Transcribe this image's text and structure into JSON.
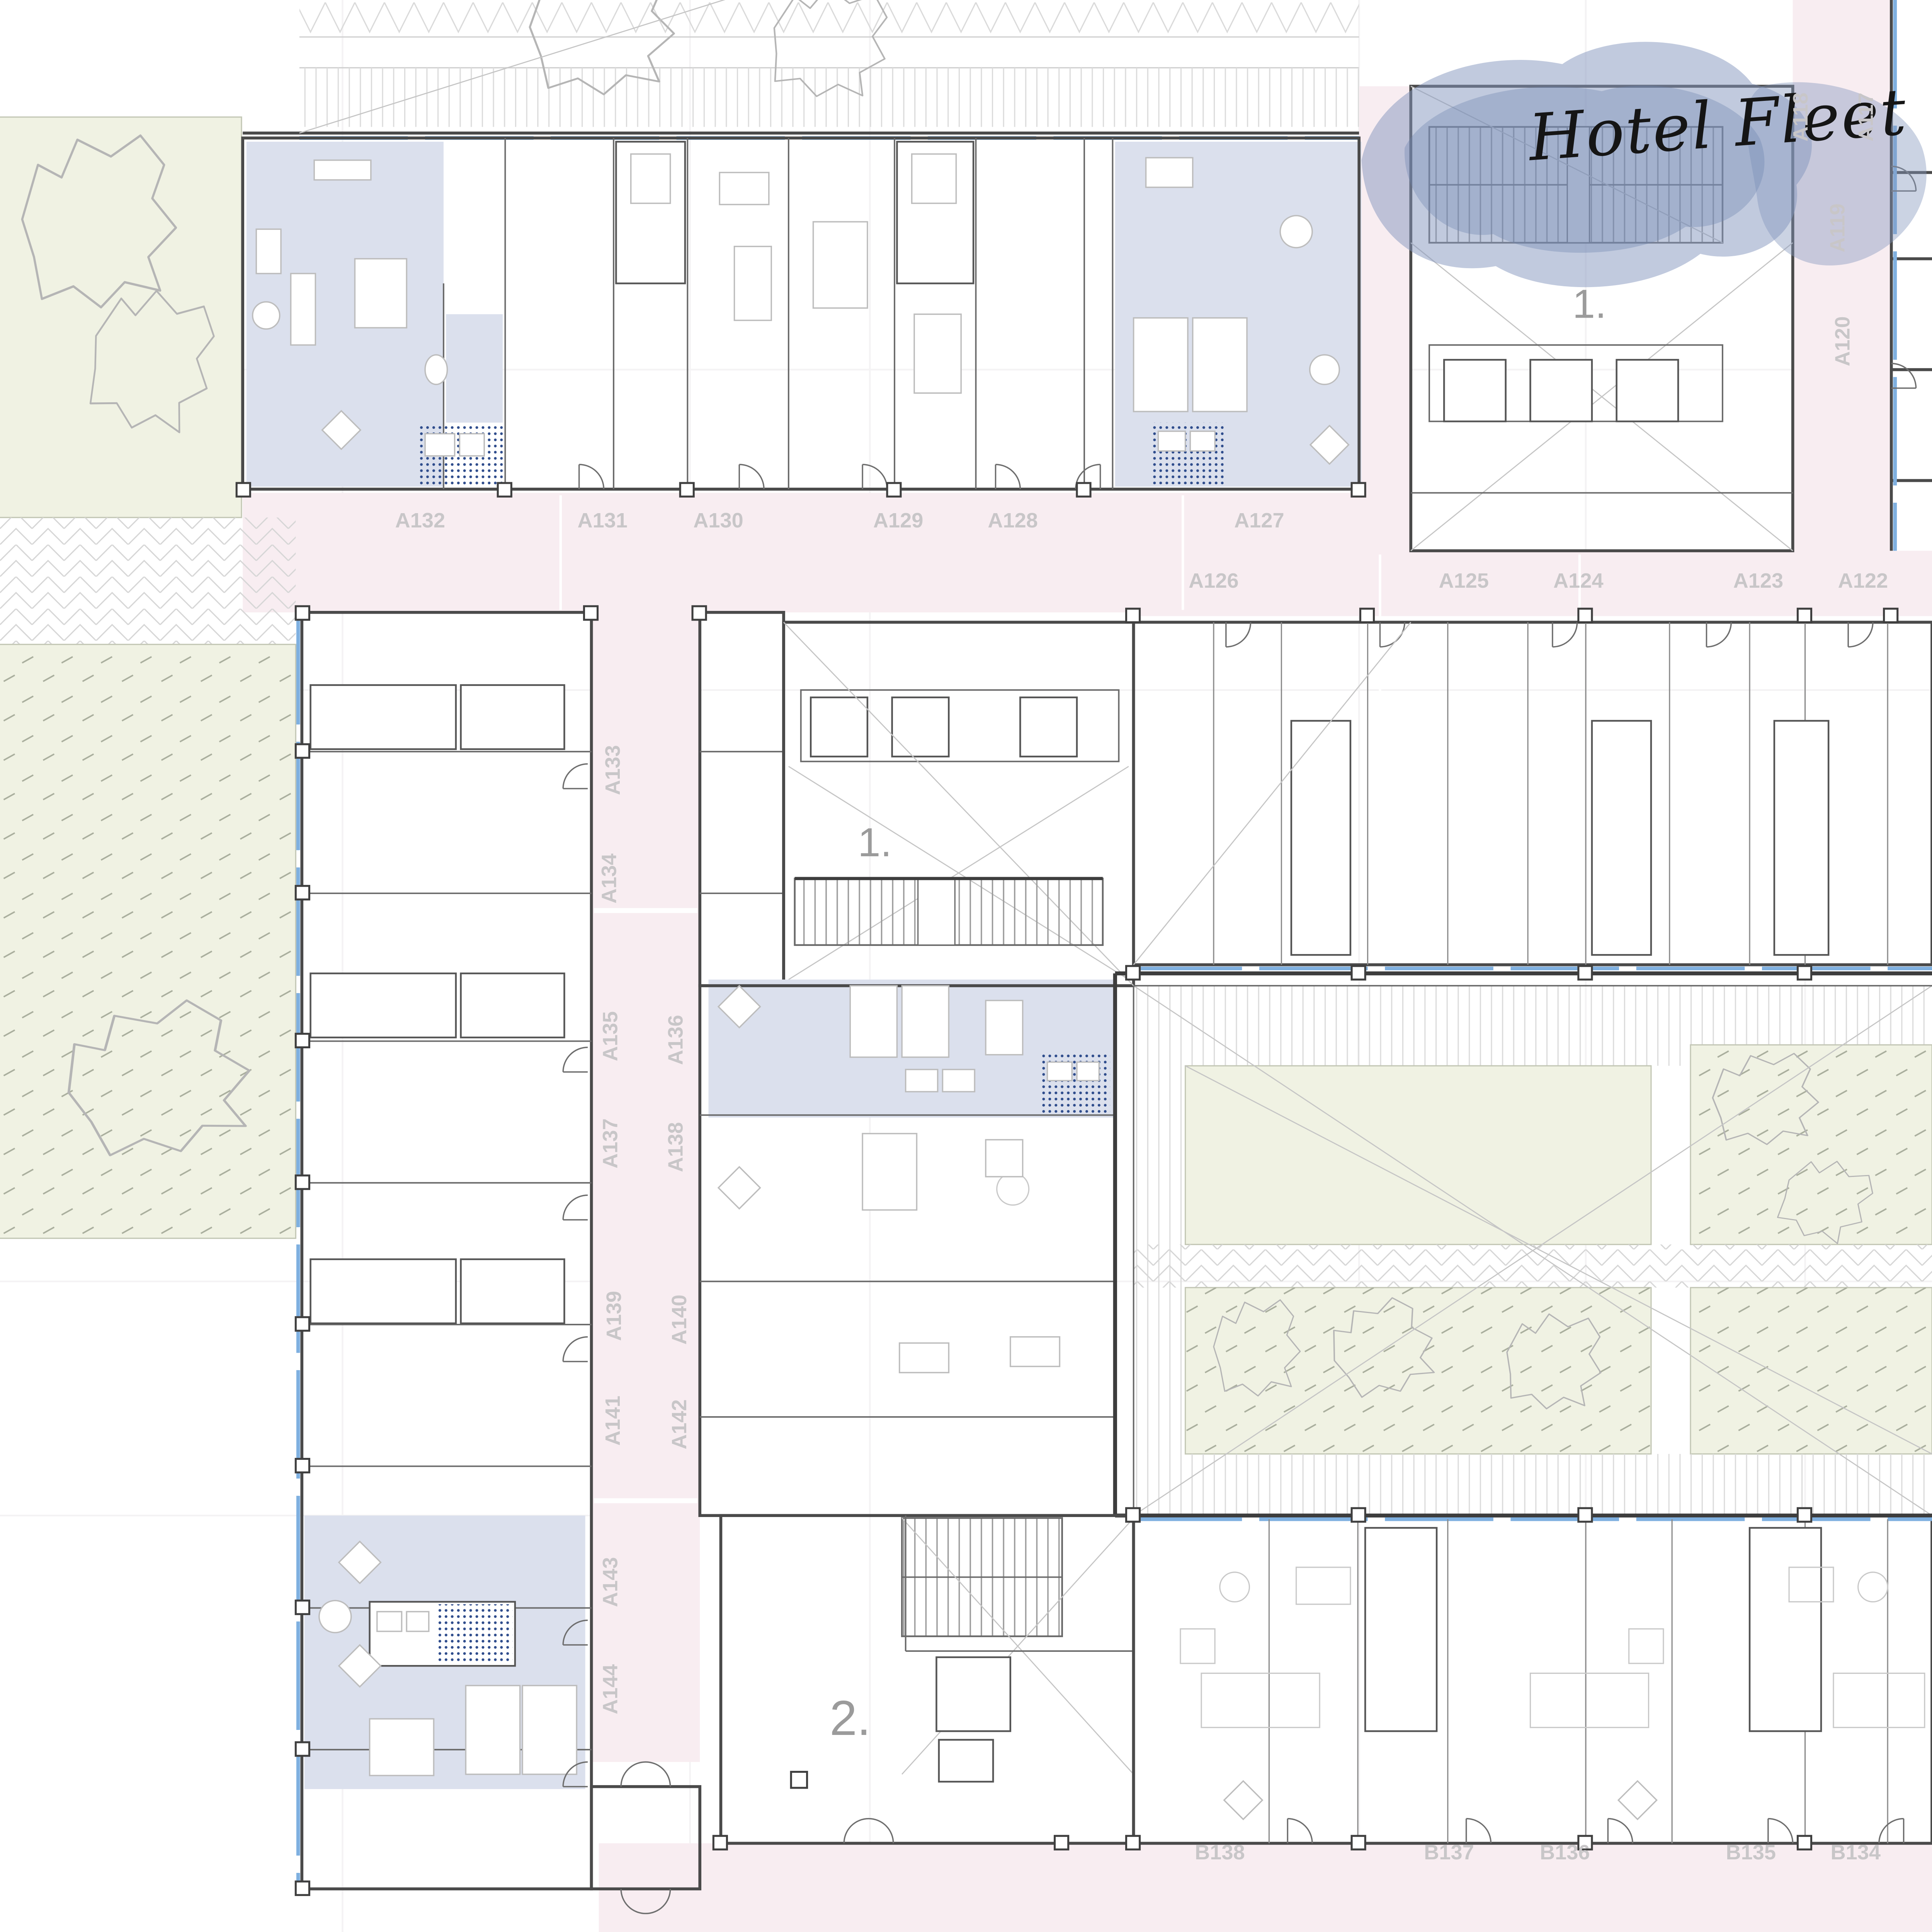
{
  "title": "Hotel Fleet",
  "markers": {
    "upper_right_floor": "1.",
    "atrium_floor": "1.",
    "lobby_floor": "2."
  },
  "corridors": {
    "top_left_labels": [
      "A132",
      "A131",
      "A130",
      "A129",
      "A128",
      "A127"
    ],
    "top_right_labels": [
      "A126",
      "A125",
      "A124",
      "A123",
      "A122"
    ],
    "right_vertical_labels": [
      "A118",
      "A117",
      "A119",
      "A120"
    ],
    "mid_vertical_labels": [
      "A133",
      "A134",
      "A135",
      "A136",
      "A137",
      "A138",
      "A139",
      "A140",
      "A141",
      "A142",
      "A143",
      "A144"
    ],
    "bottom_labels": [
      "B138",
      "B137",
      "B136",
      "B135",
      "B134"
    ]
  },
  "colors": {
    "corridor_pink": "#f8edf1",
    "room_blue": "#dbe0ed",
    "garden_green": "#f0f2e3",
    "glazing_blue": "#7fb0e0",
    "wall_gray": "#4a4a4a",
    "label_gray": "#c8c6c8",
    "marker_gray": "#9b9b9b",
    "bath_dot_blue": "#2e4c8c",
    "watercolor_blue": "#8496bd"
  }
}
